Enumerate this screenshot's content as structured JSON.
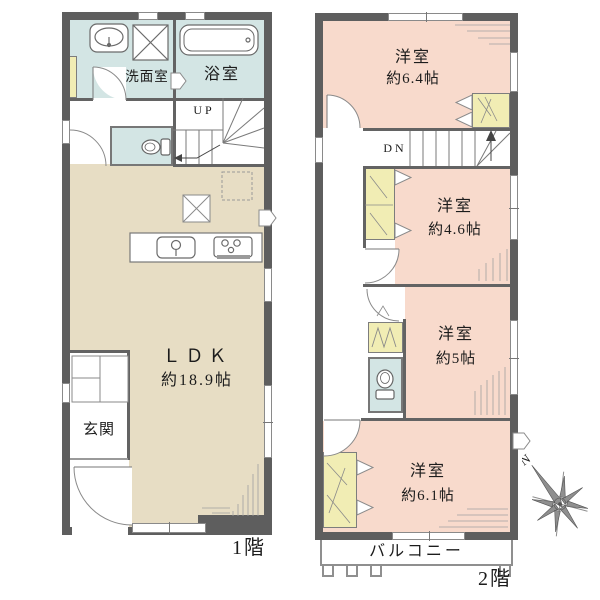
{
  "palette": {
    "wall": "#5e5e5e",
    "room_pink": "#f8dacc",
    "ldk_beige": "#e7ddc4",
    "wet_blue": "#d3e5e4",
    "closet_yellow": "#f1edb4"
  },
  "floor1": {
    "floor_label": "1階",
    "washroom": "洗面室",
    "bathroom": "浴室",
    "entrance": "玄関",
    "ldk_name": "ＬＤＫ",
    "ldk_size": "約18.9帖",
    "stairs": "UP"
  },
  "floor2": {
    "floor_label": "2階",
    "stairs": "DN",
    "balcony": "バルコニー",
    "rooms": [
      {
        "name": "洋室",
        "size": "約6.4帖"
      },
      {
        "name": "洋室",
        "size": "約4.6帖"
      },
      {
        "name": "洋室",
        "size": "約5帖"
      },
      {
        "name": "洋室",
        "size": "約6.1帖"
      }
    ]
  },
  "compass": {
    "north": "N"
  }
}
